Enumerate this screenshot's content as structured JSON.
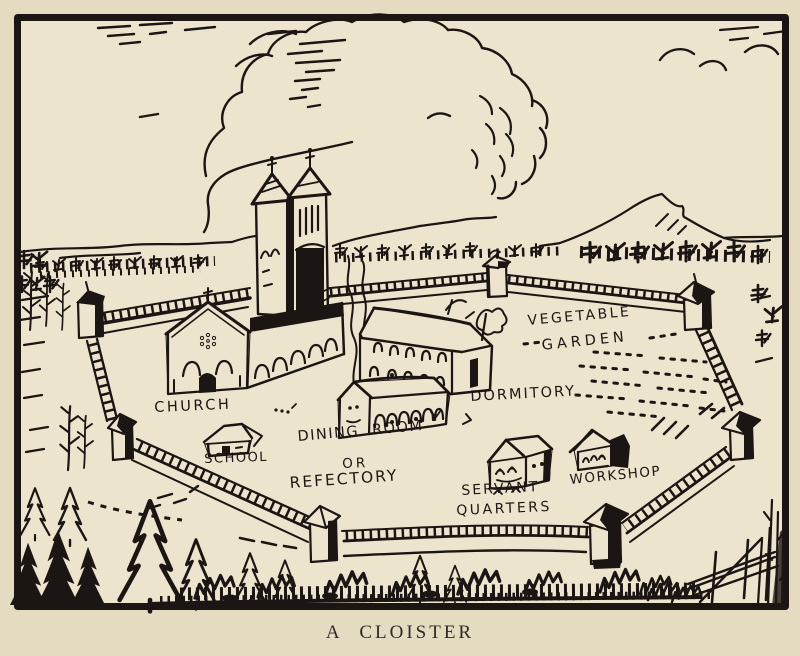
{
  "illustration": {
    "caption": "A CLOISTER",
    "labels": {
      "church": "CHURCH",
      "school": "SCHOOL",
      "dining_room_line1": "DINING ROOM",
      "dining_room_line2": "OR",
      "dining_room_line3": "REFECTORY",
      "dormitory": "DORMITORY.",
      "vegetable_garden_line1": "VEGETABLE",
      "vegetable_garden_line2": "GARDEN",
      "servant_quarters_line1": "SERVANT",
      "servant_quarters_line2": "QUARTERS",
      "workshop": "WORKSHOP"
    },
    "colors": {
      "paper": "#ede4cd",
      "margin": "#e5dbc1",
      "ink": "#1b1613",
      "caption_ink": "#2f2a24"
    }
  }
}
